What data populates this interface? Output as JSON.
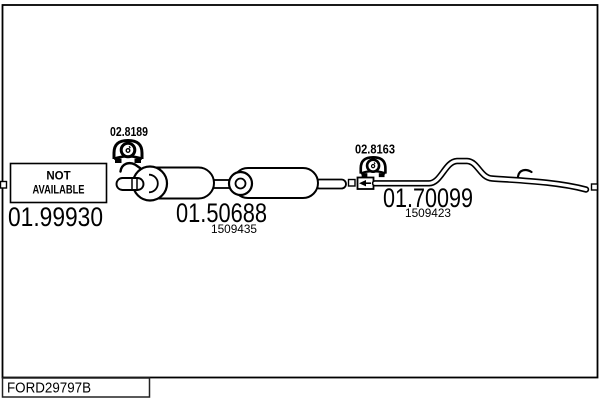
{
  "window": {
    "background_color": "#ffffff",
    "line_color": "#000000"
  },
  "diagram": {
    "type": "exhaust-system-parts-drawing",
    "front_section": {
      "part_number": "01.99930",
      "availability_line1": "NOT",
      "availability_line2": "AVAILABLE"
    },
    "center_section": {
      "part_number": "01.50688",
      "oe_reference": "1509435",
      "mount_code": "02.8189"
    },
    "rear_section": {
      "part_number": "01.70099",
      "oe_reference": "1509423",
      "mount_code": "02.8163"
    },
    "footer": {
      "drawing_code": "FORD29797B"
    },
    "icons": {
      "rubber_mount": "rubber-mount-icon",
      "connection_marker": "square-connector",
      "hanger_hook": "hook-bracket",
      "clamp": "sleeve-clamp-with-arrow"
    }
  }
}
